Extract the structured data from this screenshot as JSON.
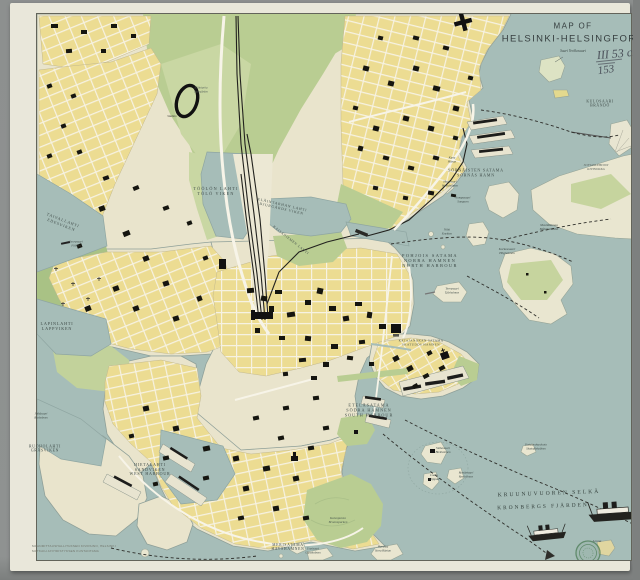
{
  "map": {
    "title_line1": "MAP OF",
    "title_line2": "HELSINKI-HELSINGFORS"
  },
  "annotations": {
    "handwritten_catalog": "III 53 c.",
    "handwritten_number": "153"
  },
  "imprint": {
    "line1": "MAANMITTAUSHALLITUKSEN KIVIPAINO, HELSINKI",
    "line2": "MATKAILIJAYHDISTYKSEN KUSTANTAMA"
  },
  "colors": {
    "water": "#a6bdb8",
    "land": "#e9e4cc",
    "city_block": "#ecdc92",
    "street": "#f6f2e2",
    "park": "#b9cd92",
    "building": "#17170f",
    "paper": "#e9e7da",
    "stamp_green": "#4e7d58"
  },
  "labels": [
    {
      "id": "suuri-verkkosaari",
      "lines": [
        "Suuri Verkkosaari"
      ],
      "x": 573,
      "y": 51,
      "size": 3.6,
      "it": true
    },
    {
      "id": "kulosaari",
      "lines": [
        "KULOSAARI",
        "BRÄNDÖ"
      ],
      "x": 600,
      "y": 104,
      "size": 3.8,
      "ls": 0.6
    },
    {
      "id": "sornaisten-satama",
      "lines": [
        "SÖRNÄISTEN SATAMA",
        "SÖRNÄS HAMN"
      ],
      "x": 476,
      "y": 173,
      "size": 4,
      "ls": 0.8
    },
    {
      "id": "kana",
      "lines": [
        "Kana",
        "Hönan"
      ],
      "x": 452,
      "y": 160,
      "size": 3.1,
      "it": true
    },
    {
      "id": "hanasaari",
      "lines": [
        "Hanasaari",
        "Hanaholmen"
      ],
      "x": 450,
      "y": 184,
      "size": 3.1,
      "it": true
    },
    {
      "id": "sompasaari",
      "lines": [
        "Sompasaari",
        "Sumparn"
      ],
      "x": 463,
      "y": 200,
      "size": 3.1,
      "it": true
    },
    {
      "id": "nihti",
      "lines": [
        "Nihti",
        "Knekten"
      ],
      "x": 447,
      "y": 232,
      "size": 3.1,
      "it": true
    },
    {
      "id": "kivinokka",
      "lines": [
        "SOFIANLEHDON",
        "KIVINOKKA"
      ],
      "x": 596,
      "y": 168,
      "size": 3.3,
      "it": true,
      "col": "#5a625c"
    },
    {
      "id": "mustikkamaa",
      "lines": [
        "Mustikkamaa",
        "Blåbärslandet"
      ],
      "x": 549,
      "y": 228,
      "size": 3.3,
      "it": true
    },
    {
      "id": "korkeasaari",
      "lines": [
        "Korkeasaari",
        "Högholmen"
      ],
      "x": 507,
      "y": 252,
      "size": 3.3,
      "it": true
    },
    {
      "id": "pohjois-satama",
      "lines": [
        "POHJOIS SATAMA",
        "NORRA HAMNEN",
        "NORTH HARBOUR"
      ],
      "x": 430,
      "y": 261,
      "size": 4.4,
      "ls": 1.4,
      "col": "#3a4745"
    },
    {
      "id": "tervasaari",
      "lines": [
        "Tervasaari",
        "Tjärholmen"
      ],
      "x": 452,
      "y": 291,
      "size": 3.1,
      "it": true
    },
    {
      "id": "kaisaniemen-lahti",
      "lines": [
        "KAISANIEMEN LAHTI"
      ],
      "x": 291,
      "y": 240,
      "size": 3.4,
      "rot": 38,
      "ls": 0.6
    },
    {
      "id": "toolonlahti",
      "lines": [
        "TÖÖLÖN LAHTI",
        "TÖLÖ VIKEN"
      ],
      "x": 216,
      "y": 192,
      "size": 4.2,
      "ls": 1.2
    },
    {
      "id": "elaintarhanlahti",
      "lines": [
        "ELÄINTARHAN LAHTI",
        "DJURGÅRDS VIKEN"
      ],
      "x": 282,
      "y": 207,
      "size": 3.6,
      "rot": 13,
      "ls": 0.8
    },
    {
      "id": "elaintarha",
      "lines": [
        "Eläintarha",
        "Djurgården"
      ],
      "x": 201,
      "y": 90,
      "size": 3,
      "it": true,
      "col": "#55605a"
    },
    {
      "id": "stadion",
      "lines": [
        "Stadion"
      ],
      "x": 172,
      "y": 117,
      "size": 3,
      "it": true,
      "col": "#3c3c34"
    },
    {
      "id": "taivallahti",
      "lines": [
        "TAIVALLAHTI",
        "EDESVIKEN"
      ],
      "x": 62,
      "y": 223,
      "size": 4,
      "rot": 21,
      "ls": 0.8
    },
    {
      "id": "seurasaari-pier",
      "lines": [
        "Seurasaari",
        "Fölisön"
      ],
      "x": 76,
      "y": 244,
      "size": 3,
      "it": true
    },
    {
      "id": "lapinlahti",
      "lines": [
        "LAPINLAHTI",
        "LAPPVIKEN"
      ],
      "x": 57,
      "y": 327,
      "size": 4.2,
      "ls": 0.8
    },
    {
      "id": "ruoholahti",
      "lines": [
        "RUOHOLAHTI",
        "GRÄSVIKEN"
      ],
      "x": 45,
      "y": 449,
      "size": 3.8,
      "ls": 0.7
    },
    {
      "id": "jatkasaari",
      "lines": [
        "Jätkäsaari",
        "Busholmen"
      ],
      "x": 41,
      "y": 416,
      "size": 3,
      "it": true
    },
    {
      "id": "hietalahti",
      "lines": [
        "HIETALAHTI",
        "SANDVIKEN",
        "WEST HARBOUR"
      ],
      "x": 150,
      "y": 470,
      "size": 4,
      "ls": 0.8
    },
    {
      "id": "etelasatama",
      "lines": [
        "ETELÄSATAMA",
        "SÖDRA HAMNEN",
        "SOUTH HARBOUR"
      ],
      "x": 369,
      "y": 411,
      "size": 4.2,
      "ls": 1
    },
    {
      "id": "katajanokan-satama",
      "lines": [
        "KATAJANOKAN SATAMA",
        "SKATUDDS HAMNEN"
      ],
      "x": 421,
      "y": 343,
      "size": 3.1,
      "ls": 0.5
    },
    {
      "id": "valkosaari",
      "lines": [
        "Valkosaari",
        "Blekholmen"
      ],
      "x": 443,
      "y": 451,
      "size": 3.2,
      "it": true
    },
    {
      "id": "luoto",
      "lines": [
        "Luoto",
        "Klippan"
      ],
      "x": 434,
      "y": 478,
      "size": 3.2,
      "it": true
    },
    {
      "id": "ryssansaari",
      "lines": [
        "Ryssänsaari",
        "Ryssholmen"
      ],
      "x": 466,
      "y": 475,
      "size": 3,
      "it": true
    },
    {
      "id": "katajanokanluoto",
      "lines": [
        "Katajanokanluoto",
        "Skatuddskobben"
      ],
      "x": 536,
      "y": 447,
      "size": 3,
      "it": true
    },
    {
      "id": "kruunuvuoren-selka",
      "lines": [
        "KRUUNUVUOREN  SELKÄ"
      ],
      "x": 549,
      "y": 494,
      "size": 5.6,
      "ls": 2,
      "rot": -2,
      "col": "#333f3b"
    },
    {
      "id": "kronbergs-fjarden",
      "lines": [
        "KRONBERGS  FJÄRDEN"
      ],
      "x": 543,
      "y": 507,
      "size": 5.4,
      "ls": 2,
      "rot": -2,
      "col": "#333f3b"
    },
    {
      "id": "lonna",
      "lines": [
        "Lonna"
      ],
      "x": 597,
      "y": 541,
      "size": 3.4,
      "it": true
    },
    {
      "id": "harakka",
      "lines": [
        "Harakka",
        "Stora Räntan"
      ],
      "x": 383,
      "y": 549,
      "size": 3,
      "it": true
    },
    {
      "id": "uunisaari",
      "lines": [
        "Uunisaari",
        "Ugnsholmen"
      ],
      "x": 313,
      "y": 551,
      "size": 3,
      "it": true
    },
    {
      "id": "merisatama",
      "lines": [
        "MERISATAMA",
        "HAVSHAMNEN"
      ],
      "x": 288,
      "y": 547,
      "size": 3.6,
      "ls": 0.8
    },
    {
      "id": "kaivopuisto",
      "lines": [
        "Kaivopuisto",
        "Brunnsparken"
      ],
      "x": 338,
      "y": 521,
      "size": 3.3,
      "it": true,
      "col": "#46564b"
    }
  ]
}
